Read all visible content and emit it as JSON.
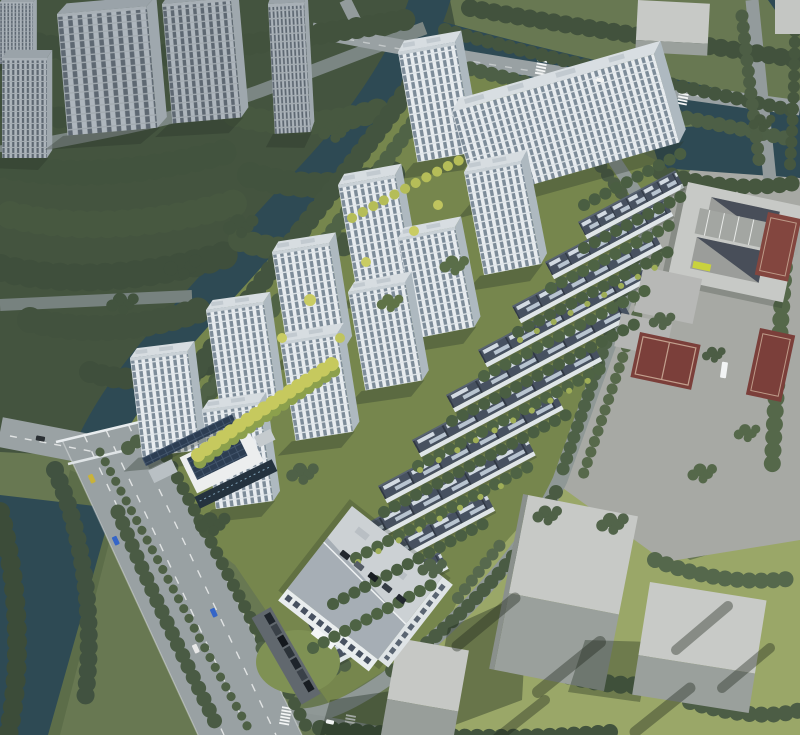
{
  "meta": {
    "title": "Aerial bird's-eye architectural rendering of a riverside residential development",
    "view": "bird's-eye",
    "render_type": "masterplan-visualization"
  },
  "palette": {
    "water": "#2e4a54",
    "forest_dark": "#44543f",
    "tree_mid": "#4e6146",
    "tree_light": "#6d8149",
    "tree_yellow": "#c6c95e",
    "site_green": "#76864d",
    "grass_light": "#9aa768",
    "road_main": "#99a1a3",
    "road_minor": "#8f9896",
    "pavement": "#a7a9a4",
    "facade_white": "#eef1f3",
    "window_blue": "#7d8c99",
    "roof_light": "#d7dde1",
    "townhouse_roof": "#475160",
    "massing_gray": "#c7c9c6",
    "massing_shade": "#9aa09c",
    "court_red": "#7b3f3a",
    "solar_panel_blue": "#2c3d52",
    "car_blue": "#3465c8"
  },
  "inventory": {
    "new_highrise_towers": 12,
    "townhouse_rows": 11,
    "existing_towers": 5,
    "gray_massing_blocks": 5,
    "basketball_courts": 3,
    "canals": 2,
    "bridges": 1
  }
}
